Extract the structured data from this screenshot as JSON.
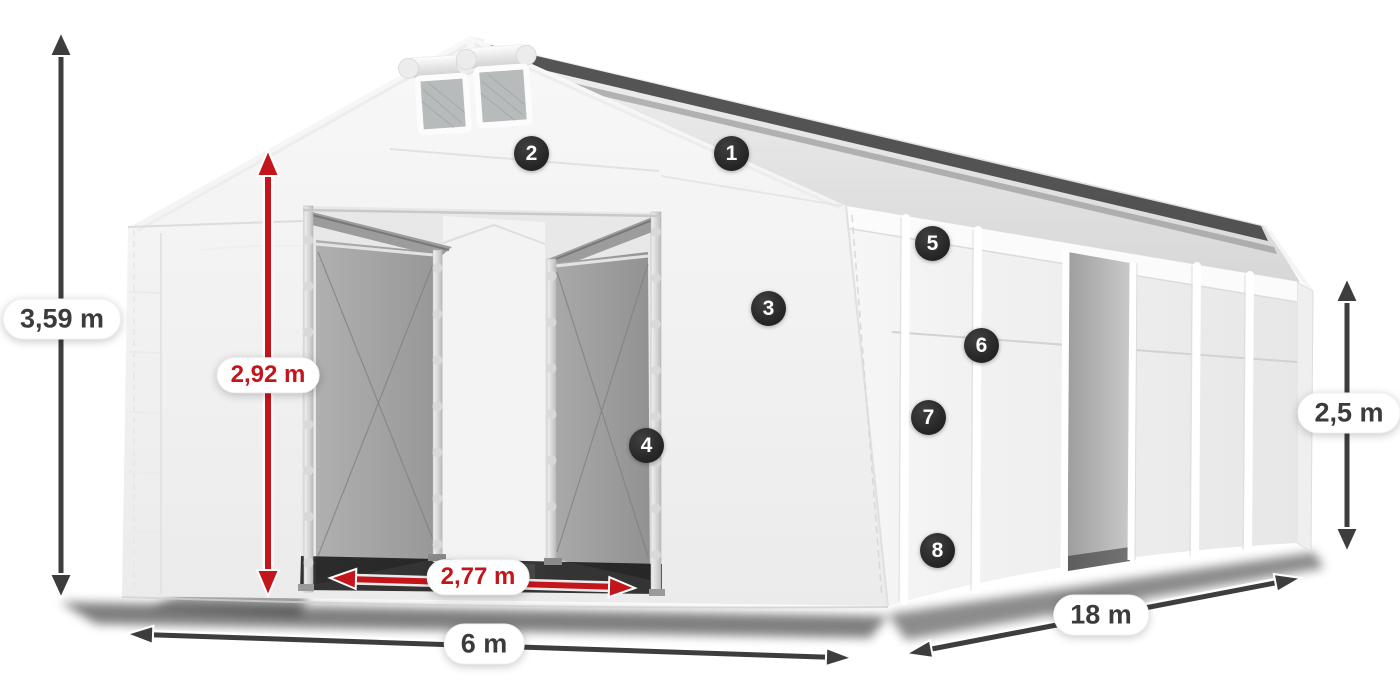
{
  "dimensions": {
    "total_height": {
      "text": "3,59 m",
      "color": "#3d3d3d"
    },
    "gate_height": {
      "text": "2,92 m",
      "color": "#c3161c"
    },
    "gate_width": {
      "text": "2,77 m",
      "color": "#c3161c"
    },
    "front_width": {
      "text": "6 m",
      "color": "#3d3d3d"
    },
    "side_length": {
      "text": "18 m",
      "color": "#3d3d3d"
    },
    "side_height": {
      "text": "2,5 m",
      "color": "#3d3d3d"
    }
  },
  "badges": [
    {
      "label": "1"
    },
    {
      "label": "2"
    },
    {
      "label": "3"
    },
    {
      "label": "4"
    },
    {
      "label": "5"
    },
    {
      "label": "6"
    },
    {
      "label": "7"
    },
    {
      "label": "8"
    }
  ],
  "colors": {
    "arrow_dark": "#3d3d3d",
    "arrow_red": "#c3161c",
    "badge_background": "#2d2d2d",
    "badge_text": "#ffffff",
    "label_background": "#ffffff",
    "tent_white": "#f4f4f4",
    "tarp_gray": "#a6a6a6"
  }
}
